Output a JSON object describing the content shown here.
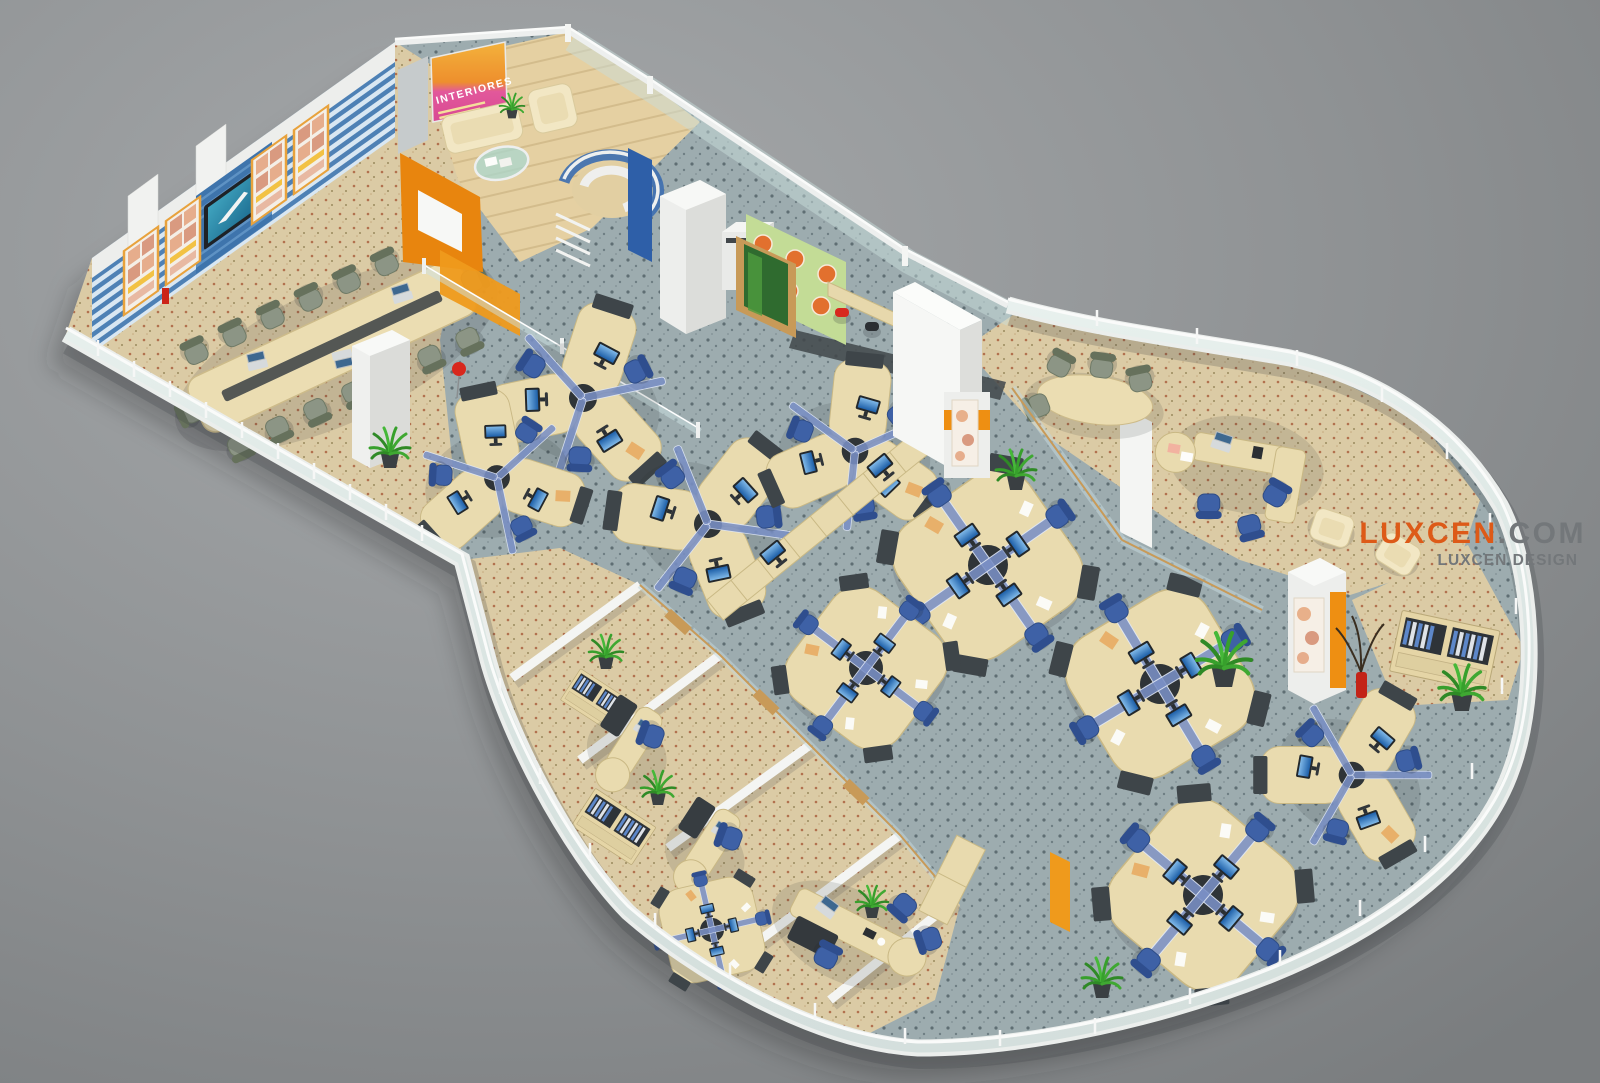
{
  "artwork": {
    "type": "3d-isometric-office-floor-plan-render",
    "studio_watermark": {
      "brand": "LUXCEN",
      "brand_suffix": ".COM",
      "tagline": "LUXCEN DESIGN",
      "brand_color": "#DD5A18",
      "tagline_color": "#73777A"
    },
    "lobby_poster": {
      "title": "INTERIORES"
    },
    "palette": {
      "background": "#8E9193",
      "shell_white": "#EFF1F0",
      "glass": "#CFE2DF",
      "open_plan_carpet": "#9DACAF",
      "office_carpet": "#DBCBA5",
      "lobby_wood": "#E5D0A2",
      "desk_maple": "#E9DBAF",
      "partition_blue": "#7A8FC5",
      "task_chair_blue": "#3E61A6",
      "meeting_chair_sage": "#8C9585",
      "accent_orange": "#EE8F12",
      "feature_wall_blue": "#4E81B5",
      "pantry_wall_green": "#C3DC96",
      "pantry_dot_orange": "#E2702E",
      "stool_red": "#D8281E",
      "monitor_screen_blue": "#2D7BC4",
      "plant_green": "#3FA832",
      "sofa_cream": "#F2E7C4",
      "poster_orange": "#F2A437",
      "poster_magenta": "#DA4D96"
    }
  }
}
